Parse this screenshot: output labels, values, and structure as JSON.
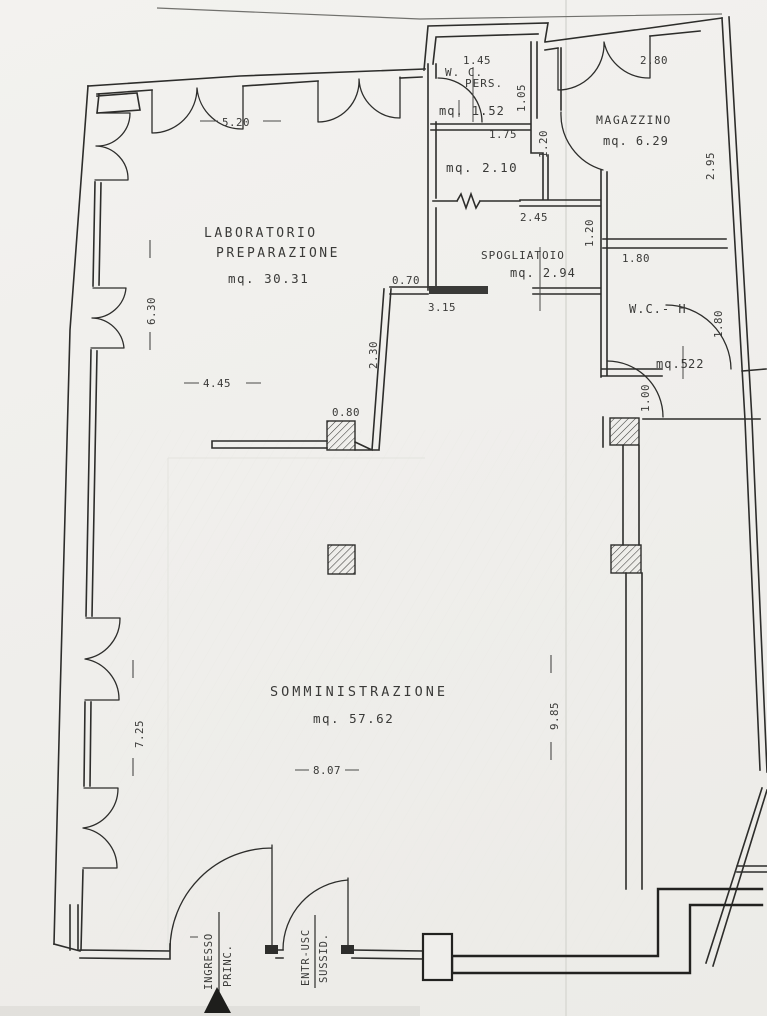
{
  "document": {
    "kind": "scanned architectural floor plan",
    "language": "Italian",
    "ink_color": "#2d2d2b",
    "paper_color": "#efeeeb"
  },
  "rooms": {
    "laboratorio": {
      "name_line1": "LABORATORIO",
      "name_line2": "PREPARAZIONE",
      "area": "mq. 30.31"
    },
    "wc_pers": {
      "name_line1": "W. C.",
      "name_line2": "PERS.",
      "area": "mq. 1.52"
    },
    "anteroom": {
      "area": "mq. 2.10"
    },
    "magazzino": {
      "name": "MAGAZZINO",
      "area": "mq. 6.29"
    },
    "spogliatoio": {
      "name": "SPOGLIATOIO",
      "area": "mq. 2.94"
    },
    "wc_h": {
      "name": "W.C.- H",
      "area_prefix": "mq.5",
      "area_suffix": "22"
    },
    "somministrazione": {
      "name": "SOMMINISTRAZIONE",
      "area": "mq. 57.62"
    }
  },
  "dimensions": {
    "lab_top": "5.20",
    "lab_left": "6.30",
    "lab_bottom": "4.45",
    "somm_left": "7.25",
    "somm_bottom": "8.07",
    "somm_right": "9.85",
    "wc_pers_width": "1.45",
    "wc_pers_depth": "1.05",
    "anteroom_width": "1.75",
    "anteroom_depth": "1.20",
    "spogliatoio_width": "2.45",
    "spogliatoio_depth": "1.20",
    "spogliatoio_wall": "3.15",
    "magazzino_width": "2.80",
    "magazzino_depth": "2.95",
    "wc_h_width": "1.80",
    "wc_h_depth": "1.80",
    "wc_h_door": "1.00",
    "niche": "0.70",
    "pillar_wall": "2.30",
    "pillar": "0.80"
  },
  "entrances": {
    "main": {
      "line1": "INGRESSO",
      "line2": "PRINC."
    },
    "secondary": {
      "line1": "ENTR-USC",
      "line2": "SUSSID."
    }
  }
}
